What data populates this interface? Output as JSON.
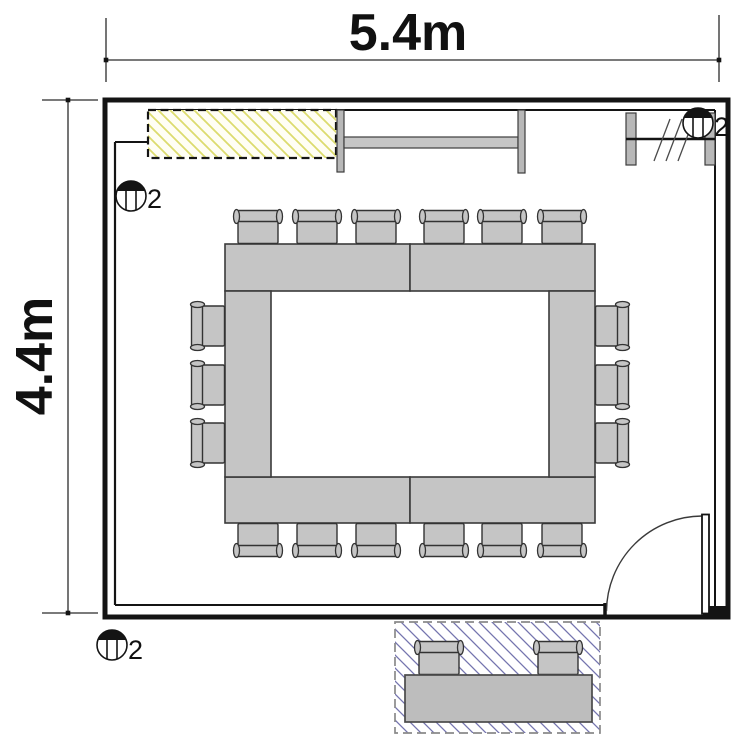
{
  "drawing_type": "meeting-room-floor-plan",
  "dimensions": {
    "width_label": "5.4m",
    "height_label": "4.4m"
  },
  "fixtures": {
    "top_left_count": "2",
    "top_right_count": "2",
    "bottom_left_count": "2"
  },
  "inventory": {
    "conference_chairs": 18,
    "outside_chairs": 2,
    "table_segments": 6,
    "outside_table": 1,
    "wall_cabinet": 1,
    "wall_rail": 1,
    "window_unit": 1,
    "door": 1
  },
  "colors": {
    "wall": "#141414",
    "furniture_fill": "#c5c5c5",
    "furniture_outline": "#3a3a3a",
    "cabinet_hatch": "#dcdc6e",
    "outside_hatch": "#7474ae",
    "dimension_text": "#111111"
  }
}
